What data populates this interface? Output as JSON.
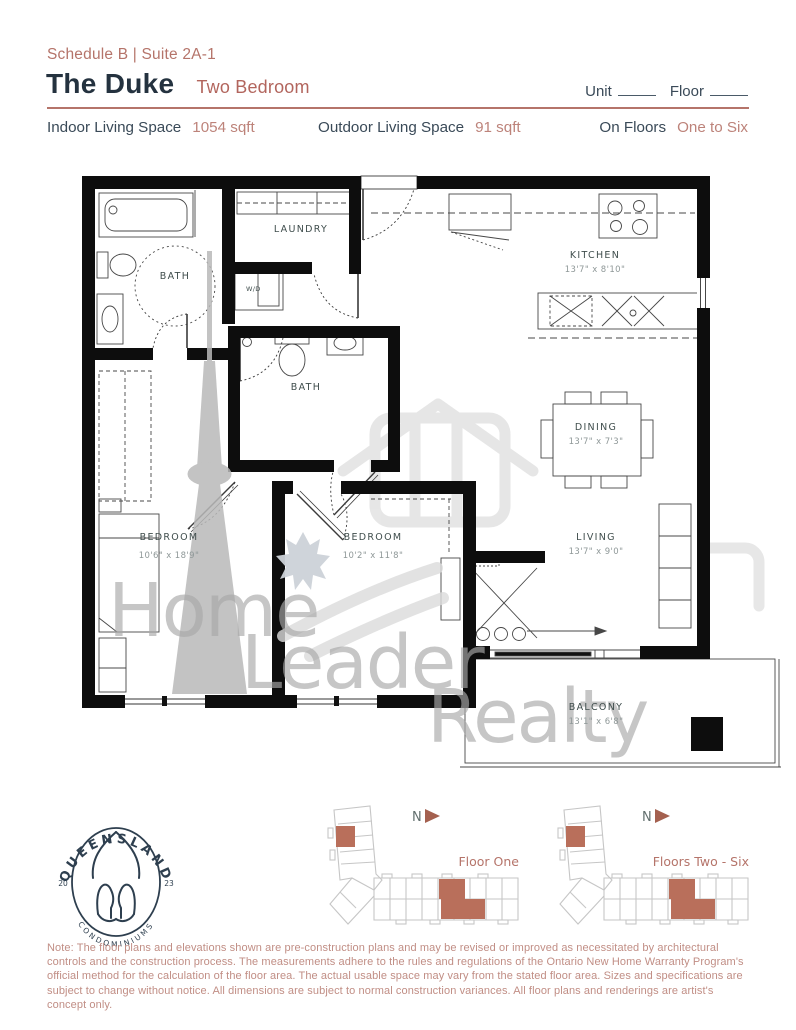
{
  "header": {
    "schedule": "Schedule B | Suite 2A-1",
    "title": "The Duke",
    "subtitle": "Two Bedroom",
    "unit_label": "Unit",
    "floor_label": "Floor"
  },
  "specs": {
    "indoor_label": "Indoor Living Space",
    "indoor_value": "1054 sqft",
    "outdoor_label": "Outdoor Living Space",
    "outdoor_value": "91 sqft",
    "floors_label": "On Floors",
    "floors_value": "One to Six"
  },
  "floorplan": {
    "rooms": {
      "bath1": {
        "name": "BATH"
      },
      "laundry": {
        "name": "LAUNDRY"
      },
      "wd": {
        "name": "W/D"
      },
      "bath2": {
        "name": "BATH"
      },
      "kitchen": {
        "name": "KITCHEN",
        "dims": "13'7\" x 8'10\""
      },
      "dining": {
        "name": "DINING",
        "dims": "13'7\" x 7'3\""
      },
      "living": {
        "name": "LIVING",
        "dims": "13'7\" x 9'0\""
      },
      "bedroom1": {
        "name": "BEDROOM",
        "dims": "10'6\" x 18'9\""
      },
      "bedroom2": {
        "name": "BEDROOM",
        "dims": "10'2\" x 11'8\""
      },
      "balcony": {
        "name": "BALCONY",
        "dims": "13'1\" x 6'8\""
      }
    },
    "watermark": {
      "line1": "Home",
      "line2": "Leader",
      "line3": "Realty"
    }
  },
  "logo": {
    "arc_top": "QUEENSLAND",
    "arc_bottom": "CONDOMINIUMS",
    "year_left": "20",
    "year_right": "23"
  },
  "keyplans": [
    {
      "north": "N",
      "caption": "Floor One"
    },
    {
      "north": "N",
      "caption": "Floors Two - Six"
    }
  ],
  "note": "Note: The floor plans and elevations shown are pre-construction plans and may be revised or improved as necessitated by architectural controls and the construction process.  The measurements adhere to the rules and regulations of the Ontario New Home Warranty Program's official method for the calculation of the floor area.  The actual usable space may vary from the stated floor area.  Sizes and specifications are subject to change without notice.  All dimensions are subject to normal construction variances.  All floor plans and renderings are artist's concept only.",
  "colors": {
    "accent": "#b5746a",
    "accent_fill": "#b96f5b",
    "navy": "#24323f",
    "wall": "#0d0d0d",
    "note_text": "#c18e85",
    "watermark_grey": "#aaaaaa"
  }
}
